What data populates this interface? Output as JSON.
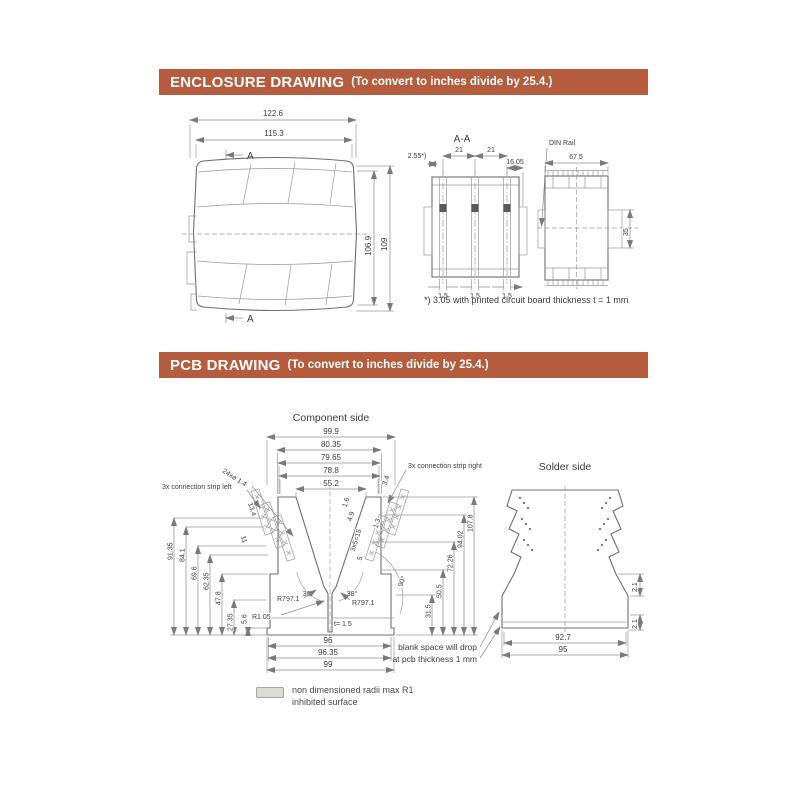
{
  "colors": {
    "header_bg": "#b45c3d",
    "header_text": "#ffffff",
    "line": "#8f8f8f",
    "text": "#3c3c3c"
  },
  "enclosure_section": {
    "title": "ENCLOSURE DRAWING",
    "subtitle": "(To convert to inches divide by 25.4.)",
    "top_view": {
      "dim_overall_width": "122.6",
      "dim_body_width": "115.3",
      "dim_body_height": "106.9",
      "dim_overall_height": "109",
      "section_marker_top": "A",
      "section_marker_bottom": "A"
    },
    "section_view": {
      "title": "A-A",
      "dim_left": "2.55*)",
      "dim_pitch_left": "21",
      "dim_pitch_right": "21",
      "dim_right": "16.05",
      "dim_slot_1": "1.5",
      "dim_slot_2": "1.5",
      "dim_slot_3": "1.5"
    },
    "side_view": {
      "din_rail_label": "DIN Rail",
      "dim_width": "67.5",
      "dim_height": "35"
    },
    "footnote": "*) 3.05 with printed circuit board thickness t = 1 mm"
  },
  "pcb_section": {
    "title": "PCB DRAWING",
    "subtitle": "(To convert to inches divide by 25.4.)",
    "component_side": {
      "title": "Component side",
      "top_dims": [
        "99.9",
        "80.35",
        "79.65",
        "78.8",
        "55.2"
      ],
      "left_dims": [
        "91.35",
        "84.1",
        "69.6",
        "62.35",
        "47.8",
        "27.35",
        "5.6"
      ],
      "right_dims": [
        "31.5",
        "50.5",
        "72.26",
        "94.02",
        "107.8"
      ],
      "bottom_dims": [
        "96",
        "96.35",
        "99"
      ],
      "holes_label": "24x⌀ 1.4",
      "strip_left_label": "3x connection strip left",
      "strip_right_label": "3x connection strip right",
      "strip_left_dims": [
        "13.4",
        "11"
      ],
      "strip_right_dims": [
        "3.4",
        "1.6",
        "4.9",
        "3x5=15",
        "5",
        "1.3"
      ],
      "angle_left": "38°",
      "angle_right": "38°",
      "angle_side": "90°",
      "radius_left": "R797.1",
      "radius_right": "R797.1",
      "radius_center": "R1.05",
      "thickness": "t=  1.5"
    },
    "solder_side": {
      "title": "Solder side",
      "dim_inner_width": "92.7",
      "dim_outer_width": "95",
      "dim_wall_top": "2.1",
      "dim_wall_bottom": "2.1"
    },
    "drop_note_line1": "blank space will drop",
    "drop_note_line2": "at pcb thickness 1 mm",
    "legend": {
      "line1": "non dimensioned radii max R1",
      "line2": "inhibited surface"
    }
  }
}
